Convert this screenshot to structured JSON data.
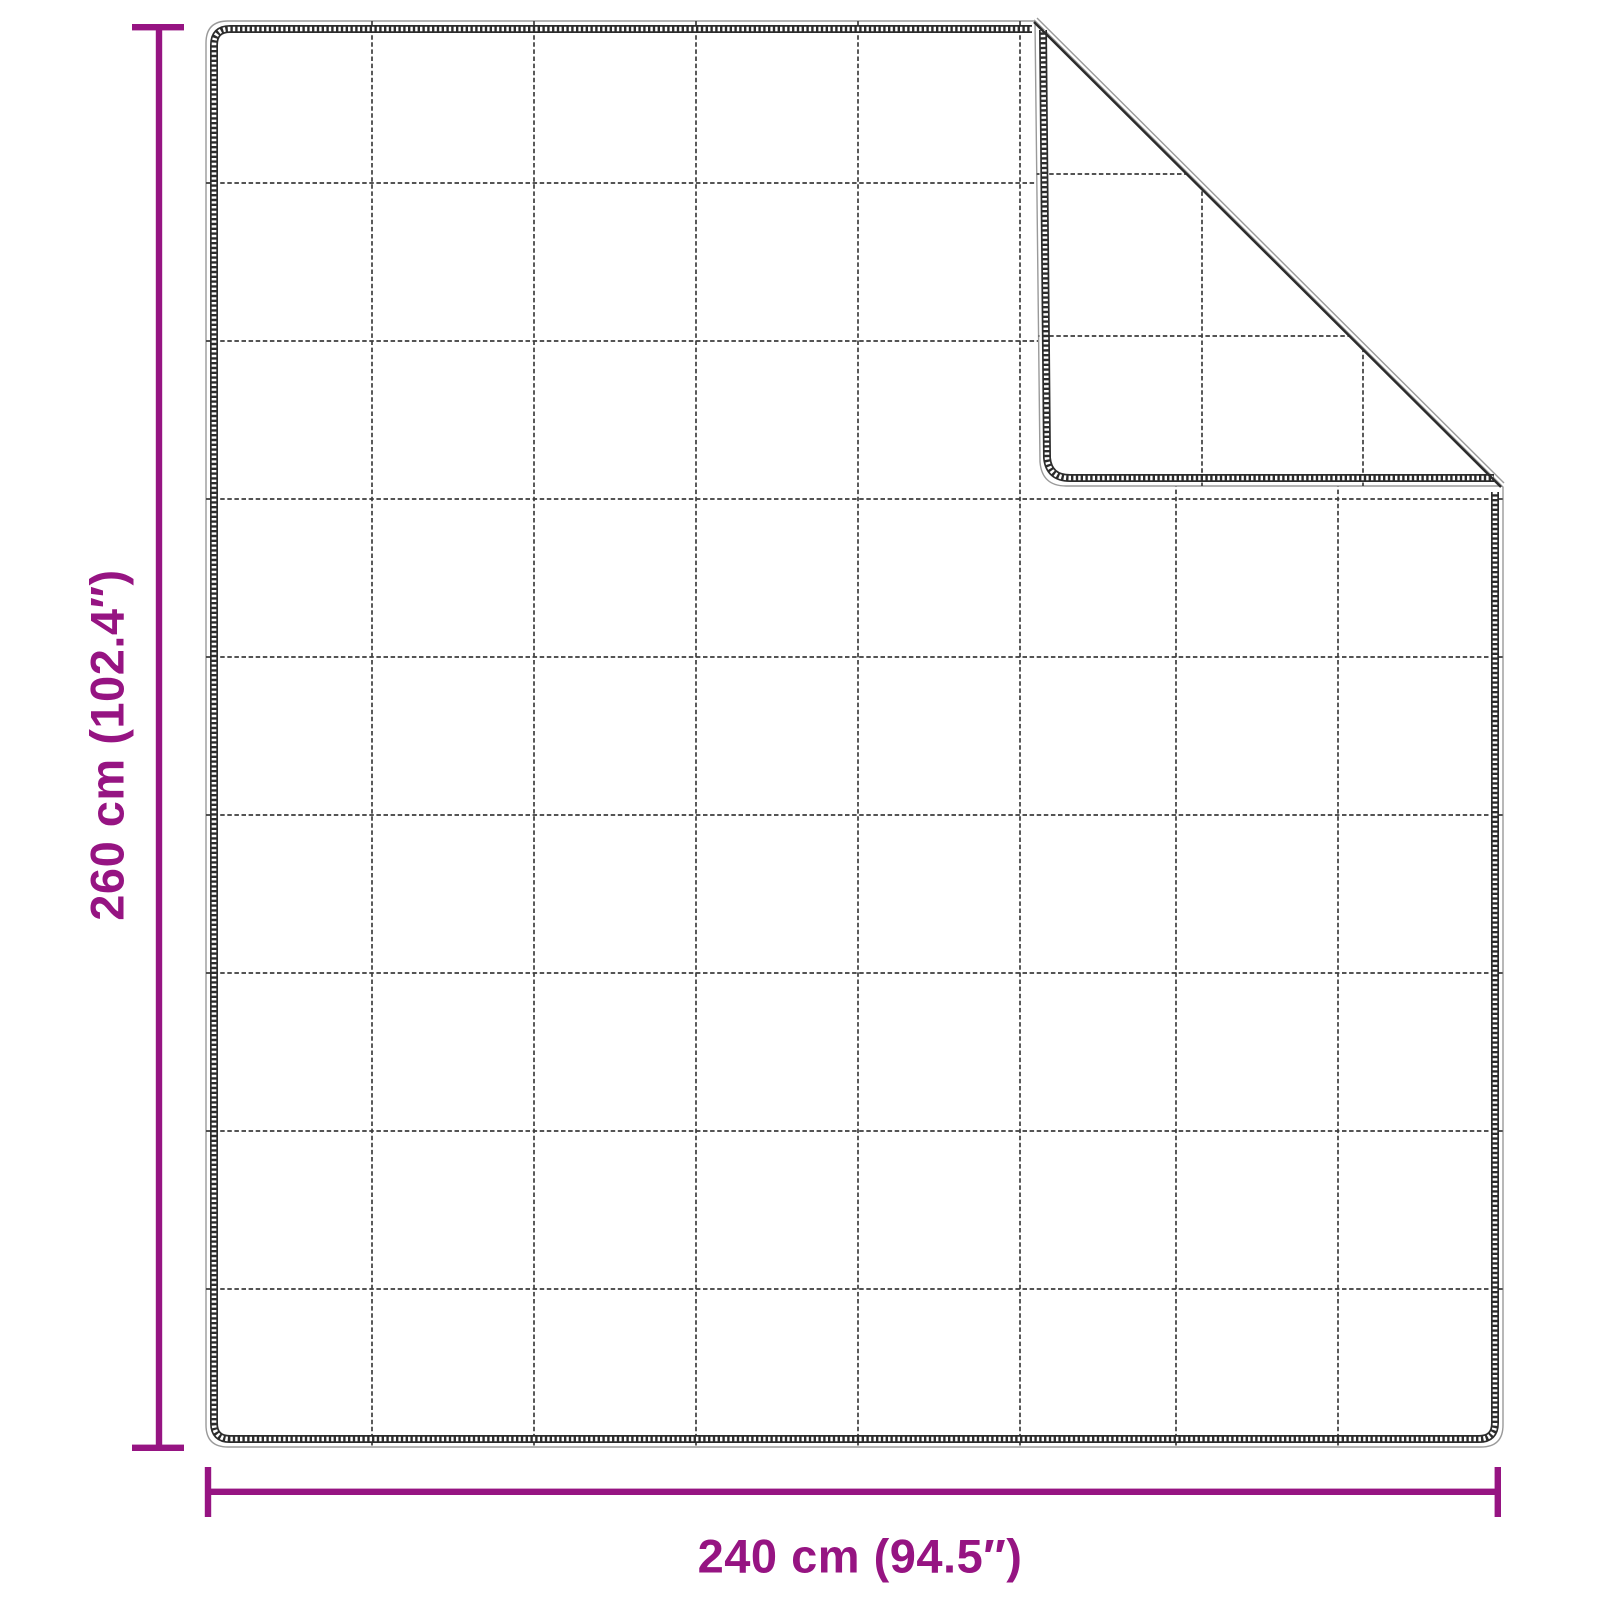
{
  "diagram": {
    "title": "blanket-dimension-diagram",
    "dimensions": {
      "height": {
        "label": "260 cm (102.4″)",
        "cm": 260,
        "inches": 102.4
      },
      "width": {
        "label": "240 cm (94.5″)",
        "cm": 240,
        "inches": 94.5
      }
    },
    "blanket": {
      "grid_columns": 8,
      "grid_rows": 9,
      "folded_corner": "top-right",
      "flap_grid_columns": 3,
      "flap_grid_rows": 3
    },
    "colors": {
      "accent": "#961482",
      "outline": "#2c2c2c",
      "stitch": "#3d3d3d",
      "edge_light": "#9a9a9a",
      "background": "#ffffff"
    }
  }
}
